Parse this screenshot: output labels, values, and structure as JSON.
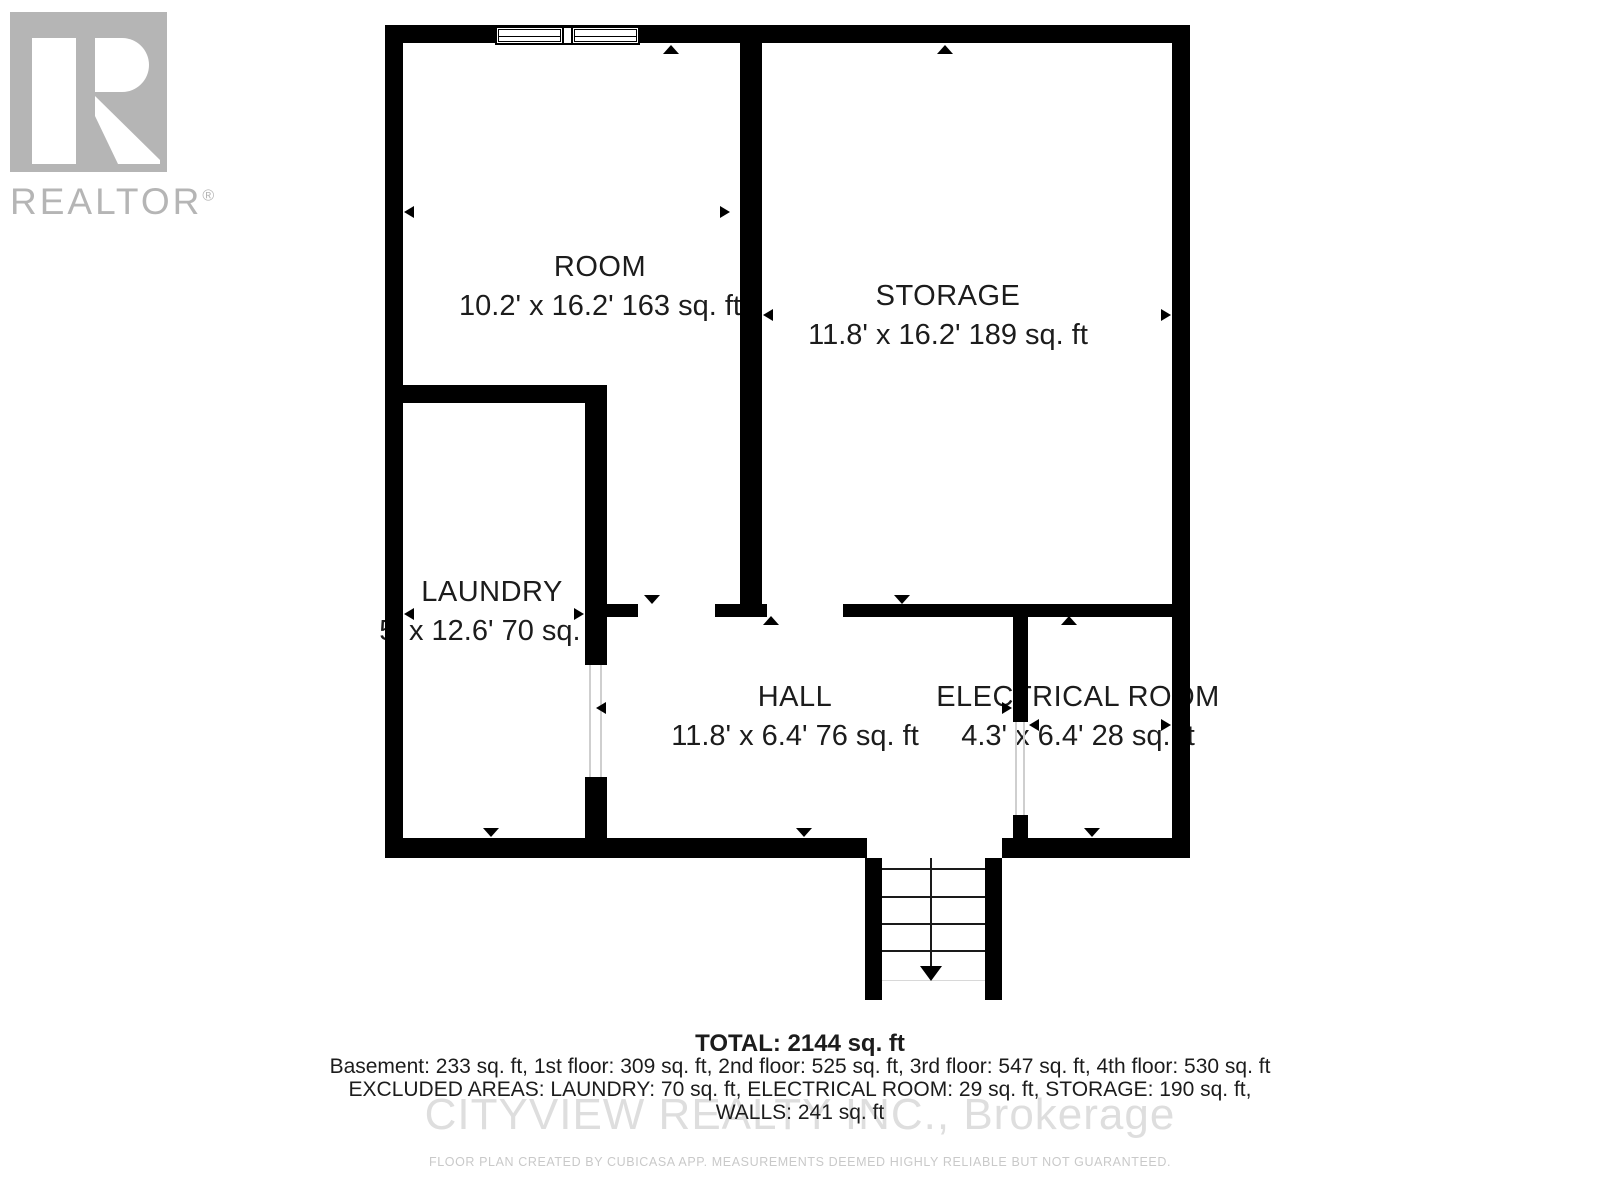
{
  "branding": {
    "logo_word": "REALTOR",
    "registered_symbol": "®"
  },
  "rooms": [
    {
      "name": "ROOM",
      "dimensions": "10.2' x 16.2' 163 sq. ft"
    },
    {
      "name": "STORAGE",
      "dimensions": "11.8' x 16.2' 189 sq. ft"
    },
    {
      "name": "LAUNDRY",
      "dimensions": "5' x 12.6' 70 sq. ft"
    },
    {
      "name": "HALL",
      "dimensions": "11.8' x 6.4' 76 sq. ft"
    },
    {
      "name": "ELECTRICAL ROOM",
      "dimensions": "4.3' x 6.4' 28 sq. ft"
    }
  ],
  "summary": {
    "total": "TOTAL: 2144 sq. ft",
    "floors": "Basement: 233 sq. ft, 1st floor: 309 sq. ft, 2nd floor: 525 sq. ft, 3rd floor: 547 sq. ft, 4th floor: 530 sq. ft",
    "excluded": "EXCLUDED AREAS: LAUNDRY: 70 sq. ft, ELECTRICAL ROOM: 29 sq. ft, STORAGE: 190 sq. ft,",
    "walls": "WALLS: 241 sq. ft"
  },
  "watermark_text": "CITYVIEW REALTY INC., Brokerage",
  "disclaimer_text": "FLOOR PLAN CREATED BY CUBICASA APP. MEASUREMENTS DEEMED HIGHLY RELIABLE BUT NOT GUARANTEED.",
  "colors": {
    "wall": "#000000",
    "label_text": "#1c1c1c",
    "watermark_gray": "#dedede",
    "logo_gray": "#b5b5b5",
    "disclaimer_gray": "#c9c9c9"
  }
}
